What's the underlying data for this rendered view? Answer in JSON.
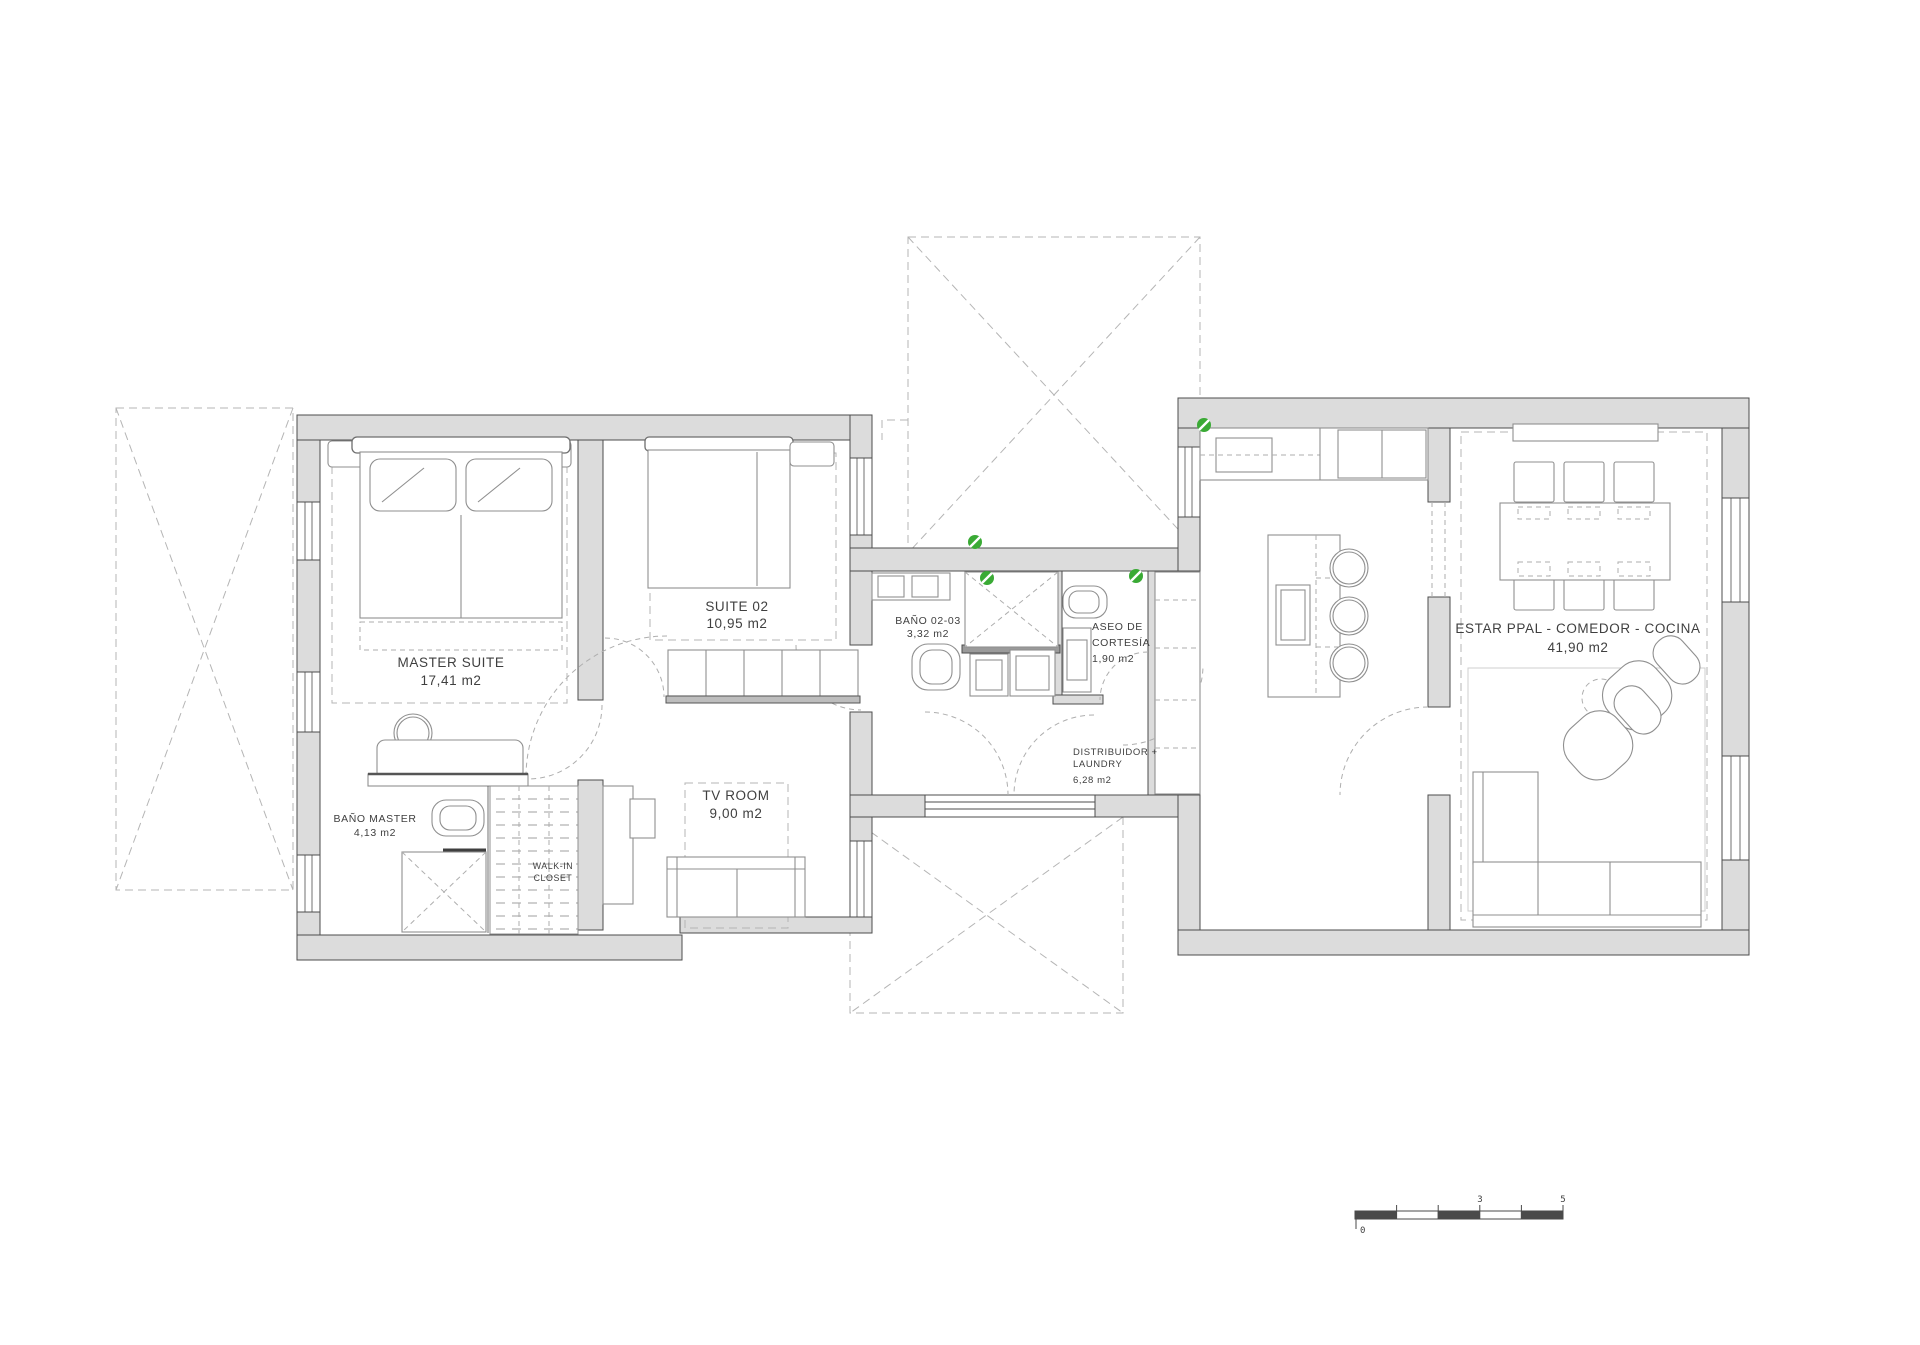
{
  "title": "Floor plan - single storey villa",
  "colors": {
    "wall_fill": "#dcdcdc",
    "wall_stroke": "#4d4d4d",
    "furniture_stroke": "#8f8f8f",
    "dashed_line": "#b5b5b5",
    "label_text": "#3f3f3f",
    "accent_green": "#3aaa35"
  },
  "rooms": {
    "master_suite": {
      "name": "MASTER SUITE",
      "area": "17,41 m2"
    },
    "suite_02": {
      "name": "SUITE 02",
      "area": "10,95 m2"
    },
    "bano_02_03": {
      "name": "BAÑO 02-03",
      "area": "3,32 m2"
    },
    "aseo_cortesia": {
      "name_line1": "ASEO DE",
      "name_line2": "CORTESÍA",
      "area": "1,90 m2"
    },
    "bano_master": {
      "name": "BAÑO MASTER",
      "area": "4,13 m2"
    },
    "walk_in_closet": {
      "name_line1": "WALK-IN",
      "name_line2": "CLOSET"
    },
    "tv_room": {
      "name": "TV ROOM",
      "area": "9,00 m2"
    },
    "distribuidor": {
      "name_line1": "DISTRIBUIDOR +",
      "name_line2": "LAUNDRY",
      "area": "6,28 m2"
    },
    "estar": {
      "name": "ESTAR PPAL - COMEDOR - COCINA",
      "area": "41,90 m2"
    }
  },
  "scale_bar": {
    "start_label": "0",
    "mid_label": "3",
    "end_label": "5"
  }
}
